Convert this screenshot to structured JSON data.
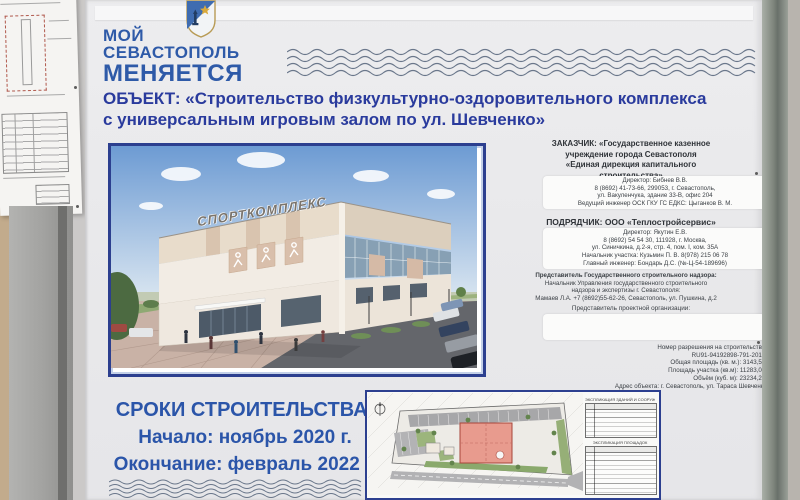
{
  "board": {
    "logo": {
      "line1": "МОЙ",
      "line2": "СЕВАСТОПОЛЬ",
      "line3": "МЕНЯЕТСЯ"
    },
    "title_line1": "ОБЪЕКТ: «Строительство физкультурно-оздоровительного комплекса",
    "title_line2": "с универсальным игровым залом по ул. Шевченко»",
    "render": {
      "sign": "СПОРТКОМПЛЕКС"
    },
    "customer": {
      "h1": "ЗАКАЗЧИК: «Государственное казенное",
      "h2": "учреждение города Севастополя",
      "h3": "«Единая дирекция капитального",
      "h4": "строительства»",
      "d1": "Директор: Бибнев В.В.",
      "d2": "8 (8692) 41-73-66, 299053, г. Севастополь,",
      "d3": "ул. Вакуленчука, здание 33-В, офис 204",
      "d4": "Ведущий инженер ОСК ГКУ ГС ЕДКС: Цыганков В. М."
    },
    "contractor": {
      "h1": "ПОДРЯДЧИК: ООО «Теплостройсервис»",
      "d1": "Директор: Якутин Е.В.",
      "d2": "8 (8692) 54 54 30, 111928, г. Москва,",
      "d3": "ул. Синичкина, д.2-я, стр. 4, пом. I, ком. 35А",
      "d4": "Начальник участка: Кузьмин П. В.   8(978) 215 06 78",
      "d5": "Главный инженер: Бондарь Д.С. (№-Ц-54-189696)"
    },
    "supervision": {
      "l1": "Представитель Государственного строительного надзора:",
      "l2": "Начальник Управления государственного строительного",
      "l3": "надзора и экспертизы г. Севастополя:",
      "l4": "Мамаев Л.А. +7 (8692)55-62-26, Севастополь, ул. Пушкина, д.2"
    },
    "design_org_label": "Представитель проектной организации:",
    "permit": {
      "l1": "Номер разрешения на строительство:",
      "l2": "RU91-94192898-791-2018;",
      "l3": "Общая площадь (кв. м.): 3143,57;",
      "l4": "Площадь участка (кв.м): 11283,00;",
      "l5": "Объём (куб. м): 23234,26;",
      "l6": "Адрес объекта: г. Севастополь, ул. Тараса Шевченко"
    },
    "timeline": {
      "header": "СРОКИ СТРОИТЕЛЬСТВА:",
      "start": "Начало: ноябрь 2020 г.",
      "end": "Окончание: февраль 2022 г."
    },
    "siteplan": {
      "table1_title": "ЭКСПЛИКАЦИЯ ЗДАНИЙ И СООРУЖЕНИЙ",
      "table2_title": "ЭКСПЛИКАЦИЯ ПЛОЩАДОК"
    }
  },
  "colors": {
    "logo_blue": "#2e5aa8",
    "title_blue": "#2a3b9d",
    "panel_border_blue": "#2c3f8f",
    "timeline_blue": "#2b55a9"
  }
}
